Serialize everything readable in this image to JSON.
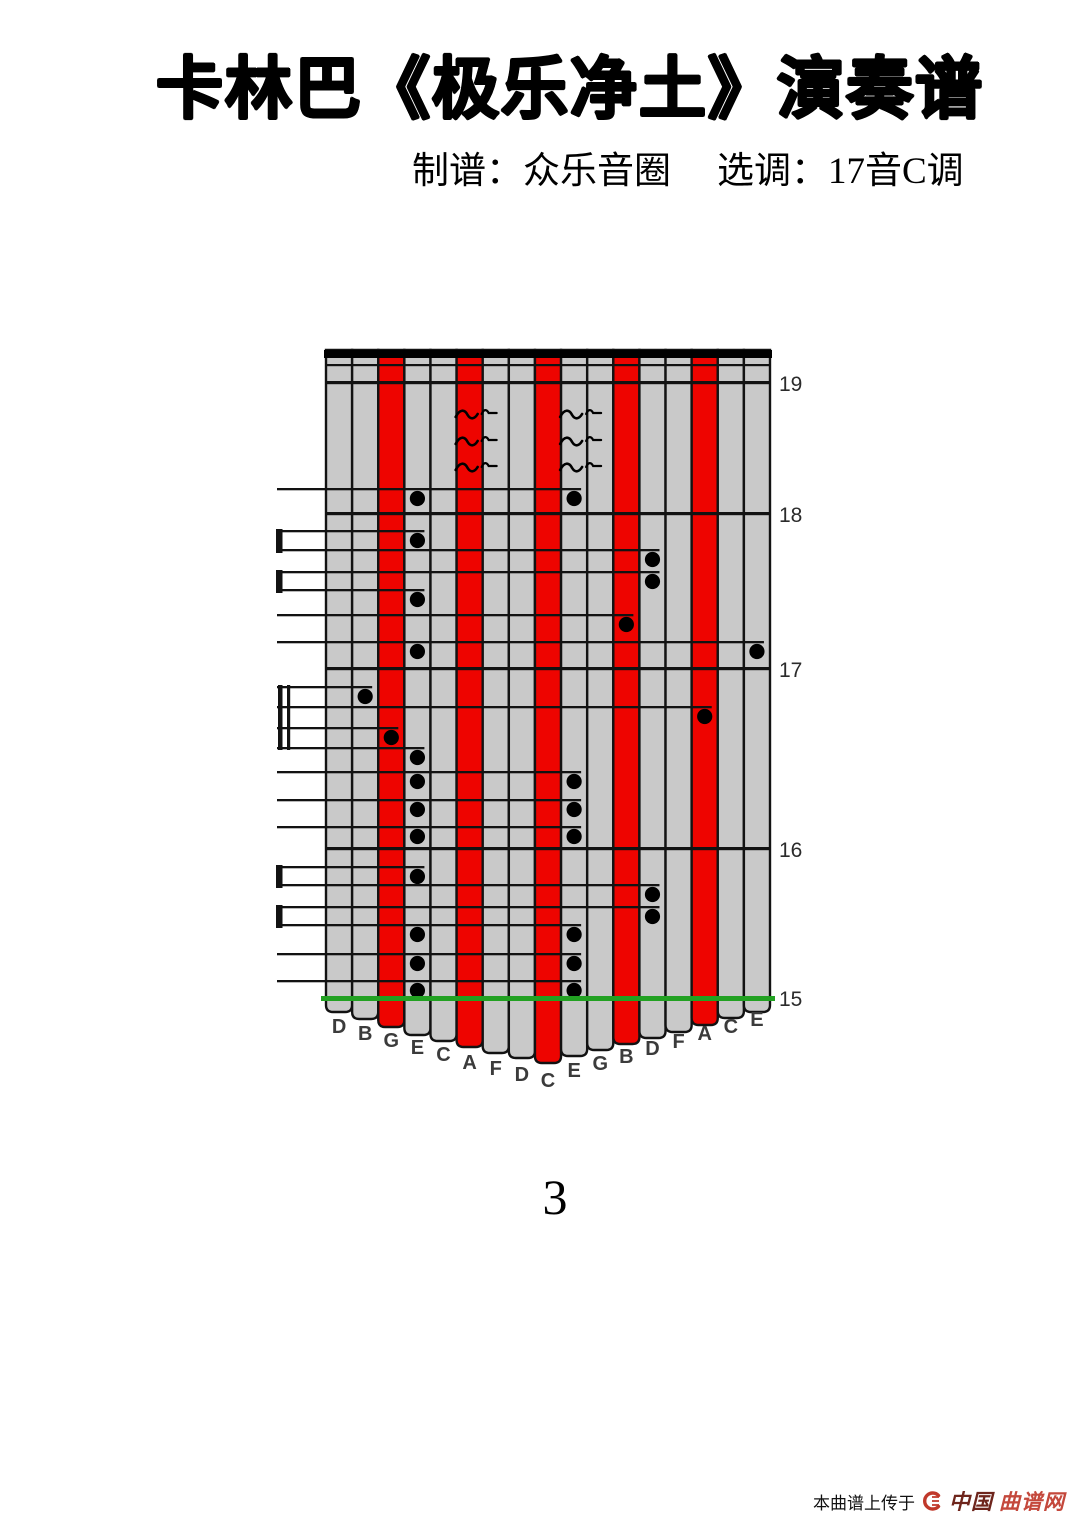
{
  "header": {
    "title": "卡林巴《极乐净土》演奏谱",
    "credit": "制谱：众乐音圈",
    "key": "选调：17音C调"
  },
  "page_number": "3",
  "watermark": {
    "prefix": "本曲谱上传于",
    "site_bold": "中国",
    "site_light": "曲谱网"
  },
  "tab": {
    "geometry": {
      "left": 326,
      "right": 770,
      "top": 350,
      "label_x": 779,
      "margin_x": 277
    },
    "colors": {
      "red": "#ee0400",
      "gray": "#c9c9c9",
      "line": "#121212",
      "green": "#22a122",
      "letter": "#3b3b3b",
      "label": "#2b2b2b"
    },
    "top_bar": {
      "y": 350,
      "height": 8
    },
    "thin_line_y": 364,
    "columns": [
      {
        "label": "D",
        "color": "gray",
        "bottom_y": 1012,
        "letter_y": 1026
      },
      {
        "label": "B",
        "color": "gray",
        "bottom_y": 1019,
        "letter_y": 1033
      },
      {
        "label": "G",
        "color": "red",
        "bottom_y": 1027,
        "letter_y": 1040
      },
      {
        "label": "E",
        "color": "gray",
        "bottom_y": 1035,
        "letter_y": 1047
      },
      {
        "label": "C",
        "color": "gray",
        "bottom_y": 1041,
        "letter_y": 1054
      },
      {
        "label": "A",
        "color": "red",
        "bottom_y": 1047,
        "letter_y": 1062
      },
      {
        "label": "F",
        "color": "gray",
        "bottom_y": 1053,
        "letter_y": 1068
      },
      {
        "label": "D",
        "color": "gray",
        "bottom_y": 1058,
        "letter_y": 1074
      },
      {
        "label": "C",
        "color": "red",
        "bottom_y": 1063,
        "letter_y": 1080
      },
      {
        "label": "E",
        "color": "gray",
        "bottom_y": 1056,
        "letter_y": 1070
      },
      {
        "label": "G",
        "color": "gray",
        "bottom_y": 1050,
        "letter_y": 1063
      },
      {
        "label": "B",
        "color": "red",
        "bottom_y": 1044,
        "letter_y": 1056
      },
      {
        "label": "D",
        "color": "gray",
        "bottom_y": 1038,
        "letter_y": 1048
      },
      {
        "label": "F",
        "color": "gray",
        "bottom_y": 1032,
        "letter_y": 1041
      },
      {
        "label": "A",
        "color": "red",
        "bottom_y": 1025,
        "letter_y": 1033
      },
      {
        "label": "C",
        "color": "gray",
        "bottom_y": 1018,
        "letter_y": 1026
      },
      {
        "label": "E",
        "color": "gray",
        "bottom_y": 1012,
        "letter_y": 1019
      }
    ],
    "measures": [
      {
        "label": "19",
        "y": 381,
        "green": false
      },
      {
        "label": "18",
        "y": 512,
        "green": false
      },
      {
        "label": "17",
        "y": 667,
        "green": false
      },
      {
        "label": "16",
        "y": 847,
        "green": false
      },
      {
        "label": "15",
        "y": 996,
        "green": true
      }
    ],
    "tremolo": {
      "columns": [
        6,
        10
      ],
      "rows_y": [
        414,
        441,
        467
      ]
    },
    "rows": [
      {
        "stem_y": 488,
        "end_col": 10,
        "dots": [
          {
            "col": 4
          },
          {
            "col": 10
          }
        ]
      },
      {
        "stem_y": 530,
        "end_col": 4,
        "dots": [
          {
            "col": 4
          }
        ]
      },
      {
        "stem_y": 549,
        "end_col": 13,
        "dots": [
          {
            "col": 13
          }
        ]
      },
      {
        "stem_y": 571,
        "end_col": 13,
        "dots": [
          {
            "col": 13
          }
        ]
      },
      {
        "stem_y": 589,
        "end_col": 4,
        "dots": [
          {
            "col": 4
          }
        ]
      },
      {
        "stem_y": 614,
        "end_col": 12,
        "dots": [
          {
            "col": 12
          }
        ]
      },
      {
        "stem_y": 641,
        "end_col": 17,
        "dots": [
          {
            "col": 4
          },
          {
            "col": 17
          }
        ]
      },
      {
        "stem_y": 686,
        "end_col": 2,
        "dots": [
          {
            "col": 2
          }
        ]
      },
      {
        "stem_y": 706,
        "end_col": 15,
        "dots": [
          {
            "col": 15
          }
        ]
      },
      {
        "stem_y": 727,
        "end_col": 3,
        "dots": [
          {
            "col": 3
          }
        ]
      },
      {
        "stem_y": 747,
        "end_col": 4,
        "dots": [
          {
            "col": 4
          }
        ]
      },
      {
        "stem_y": 771,
        "end_col": 10,
        "dots": [
          {
            "col": 4
          },
          {
            "col": 10
          }
        ]
      },
      {
        "stem_y": 799,
        "end_col": 10,
        "dots": [
          {
            "col": 4
          },
          {
            "col": 10
          }
        ]
      },
      {
        "stem_y": 826,
        "end_col": 10,
        "dots": [
          {
            "col": 4
          },
          {
            "col": 10
          }
        ]
      },
      {
        "stem_y": 866,
        "end_col": 4,
        "dots": [
          {
            "col": 4
          }
        ]
      },
      {
        "stem_y": 884,
        "end_col": 13,
        "dots": [
          {
            "col": 13
          }
        ]
      },
      {
        "stem_y": 906,
        "end_col": 13,
        "dots": [
          {
            "col": 13
          }
        ]
      },
      {
        "stem_y": 924,
        "end_col": 10,
        "dots": [
          {
            "col": 4
          },
          {
            "col": 10
          }
        ]
      },
      {
        "stem_y": 953,
        "end_col": 10,
        "dots": [
          {
            "col": 4
          },
          {
            "col": 10
          }
        ]
      },
      {
        "stem_y": 980,
        "end_col": 10,
        "dots": [
          {
            "col": 4
          },
          {
            "col": 10
          }
        ]
      }
    ],
    "brackets": [
      {
        "top": 530,
        "bottom": 549
      },
      {
        "top": 571,
        "bottom": 589
      },
      {
        "top": 866,
        "bottom": 884
      },
      {
        "top": 906,
        "bottom": 924
      }
    ],
    "beam": {
      "y1": 685,
      "y2": 750
    }
  }
}
